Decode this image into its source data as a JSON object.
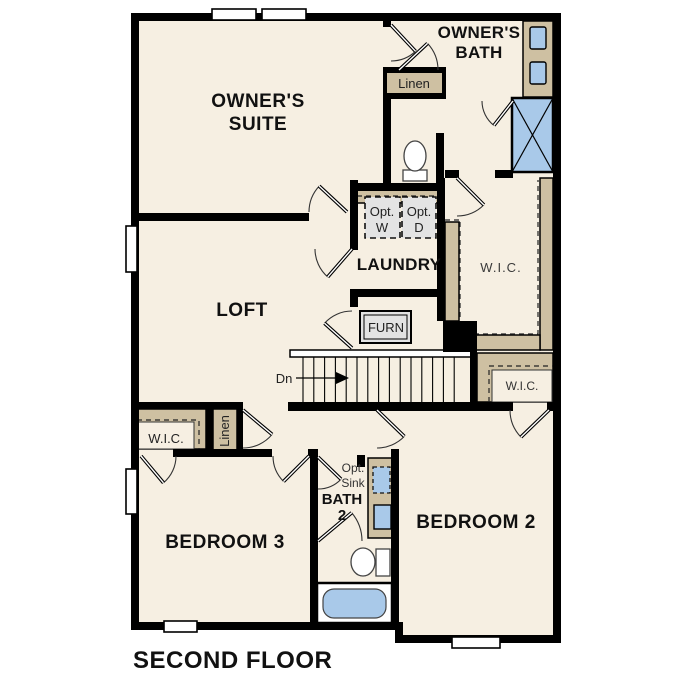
{
  "plan": {
    "title": "SECOND FLOOR",
    "stairs_direction": "Dn"
  },
  "colors": {
    "floor": "#f6efe2",
    "wall": "#000000",
    "cabinetry_tan": "#cec0a2",
    "fixture_blue": "#a9c9e9",
    "appliance_gray": "#e3e3e3"
  },
  "rooms": {
    "owners_suite": {
      "line1": "OWNER'S",
      "line2": "SUITE"
    },
    "owners_bath": {
      "line1": "OWNER'S",
      "line2": "BATH"
    },
    "linen_upper": {
      "label": "Linen"
    },
    "laundry": {
      "label": "LAUNDRY"
    },
    "opt_washer": {
      "line1": "Opt.",
      "line2": "W"
    },
    "opt_dryer": {
      "line1": "Opt.",
      "line2": "D"
    },
    "wic_owner": {
      "label": "W.I.C."
    },
    "loft": {
      "label": "LOFT"
    },
    "furnace": {
      "label": "FURN"
    },
    "wic_bedroom2": {
      "label": "W.I.C."
    },
    "wic_bedroom3": {
      "label": "W.I.C."
    },
    "linen_lower": {
      "label": "Linen"
    },
    "bedroom3": {
      "label": "BEDROOM 3"
    },
    "bath2": {
      "opt_line1": "Opt.",
      "opt_line2": "Sink",
      "line1": "BATH",
      "line2": "2"
    },
    "bedroom2": {
      "label": "BEDROOM 2"
    }
  }
}
